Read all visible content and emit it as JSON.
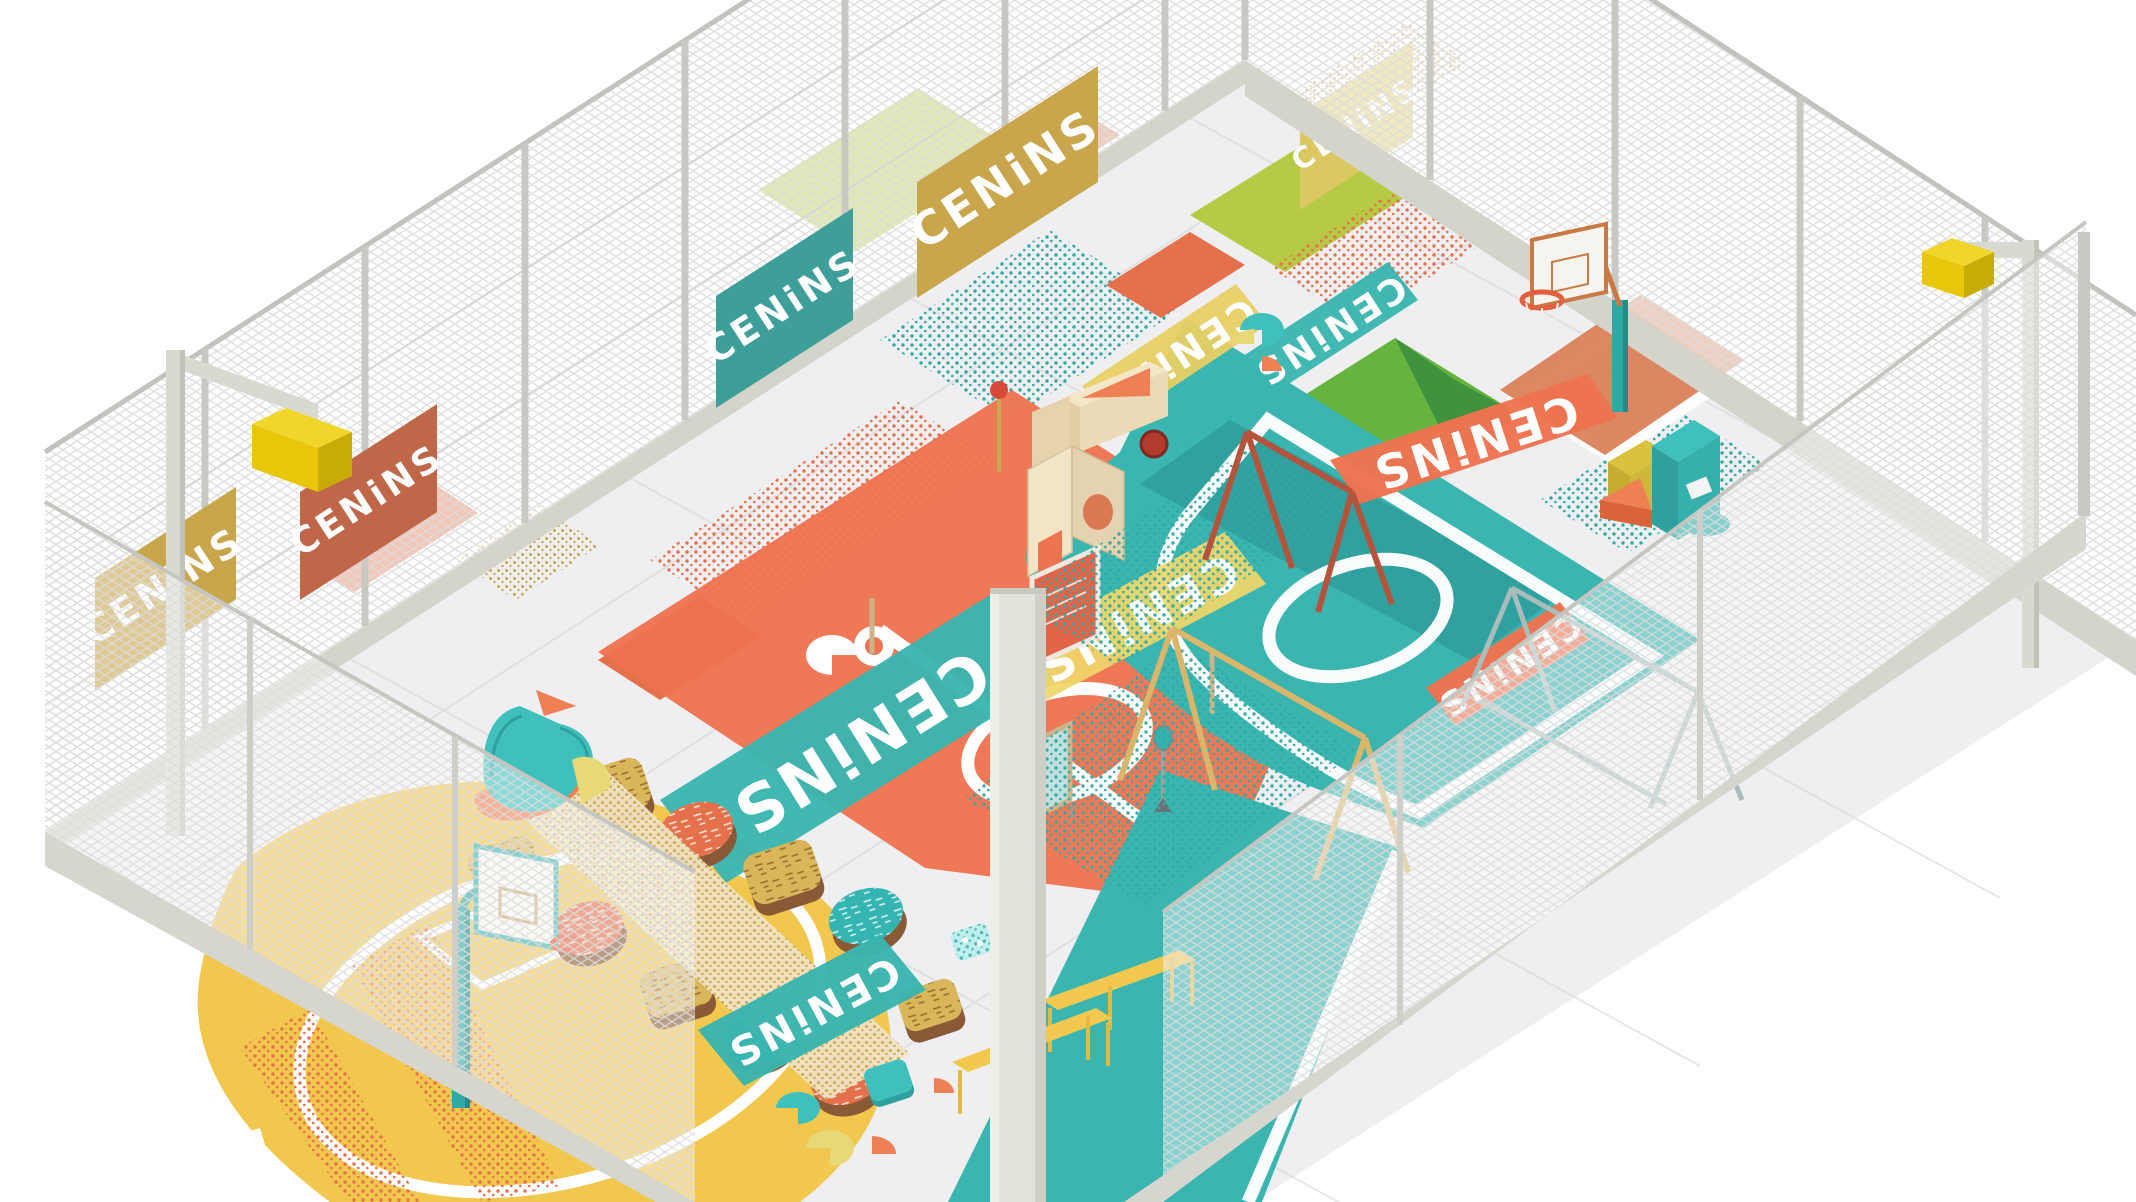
{
  "meta": {
    "type": "3d-isometric-render",
    "subject": "Fenced multi-sport playground court with CENiNS stencil branding",
    "canvas": {
      "width": 2136,
      "height": 1202
    },
    "background": "#ffffff"
  },
  "brand": {
    "stencil_text": "CENiNS",
    "style": "geometric cut-out stencil letters",
    "text_color": "#ffffff"
  },
  "palette": {
    "concrete": "#efeff1",
    "concrete_seam": "#d4d4d8",
    "curb": "#d4d4cb",
    "mesh": "#dcdcdc",
    "post": "#c6c6c0",
    "teal_court": "#3ab5b0",
    "teal_dark": "#2f9e9b",
    "teal_object": "#3fc0bd",
    "orange_court": "#ee7350",
    "orange_deep": "#e2603f",
    "yellow_court": "#f2c74e",
    "bench_yellow": "#f2c84f",
    "gold_banner": "#c9a64b",
    "pale_yellow_banner": "#dcc763",
    "lime_patch": "#b6ca45",
    "green_patch": "#67b33f",
    "green_dark": "#41923d",
    "rust_frame": "#bc5b41",
    "tan_frame": "#d9b66a",
    "steel_frame": "#a9bdbd",
    "plywood": "#ecdcbc",
    "wood_brown": "#8a5a36",
    "lamp_yellow": "#e8c70a",
    "white_line": "#ffffff"
  },
  "fence": {
    "mesh": "white chain-link on concrete curb",
    "banners": [
      {
        "id": "fence-banner-1",
        "color": "#c9a64b",
        "text": "CENiNS"
      },
      {
        "id": "fence-banner-2",
        "color": "#c0674a",
        "text": "CENiNS"
      },
      {
        "id": "fence-banner-3",
        "color": "#3e9e99",
        "text": "CENiNS"
      },
      {
        "id": "fence-banner-4",
        "color": "#c9a64b",
        "text": "CENiNS"
      },
      {
        "id": "fence-banner-5",
        "color": "#dcc763",
        "text": "CENiNS"
      }
    ]
  },
  "ground_banners": [
    {
      "id": "ground-banner-teal-center",
      "color": "#3ab5b0",
      "text": "CENiNS",
      "mirrored": true
    },
    {
      "id": "fabric-banner-yellow",
      "color": "#f0d66a",
      "text": "CENiNS",
      "mirrored": true
    },
    {
      "id": "court-banner-orange-upper",
      "color": "#ee7350",
      "text": "CENiNS",
      "mirrored": true
    },
    {
      "id": "court-banner-orange-lower",
      "color": "#ee7350",
      "text": "CENiNS",
      "mirrored": true
    },
    {
      "id": "ground-banner-yellow-north",
      "color": "#e8cf63",
      "text": "CENiNS",
      "mirrored": true
    },
    {
      "id": "ground-banner-teal-north",
      "color": "#3ab5b0",
      "text": "CENiNS",
      "mirrored": true
    },
    {
      "id": "court-banner-teal-yellowcourt",
      "color": "#3ab5b0",
      "text": "CENiNS",
      "mirrored": true
    }
  ],
  "courts": [
    {
      "name": "teal multi-sport court",
      "color": "#3ab5b0",
      "markings": [
        "white rounded boundary",
        "center circle",
        "key box at hoop",
        "large corner arc",
        "dark teal band"
      ]
    },
    {
      "name": "orange centre court",
      "color": "#ee7350",
      "markings": [
        "white center circle",
        "halfway line",
        "white quarter-disc glyphs"
      ]
    },
    {
      "name": "yellow half court",
      "color": "#f2c74e",
      "markings": [
        "white three-point ring",
        "key outline",
        "white quarter-disc glyph"
      ]
    }
  ],
  "patches": [
    "lime strips",
    "grass-green rectangles",
    "teal confetti strips",
    "orange confetti strips",
    "gold confetti strips",
    "orange rectangles"
  ],
  "equipment": [
    {
      "name": "basketball hoop north-east",
      "parts": "teal post, white backboard with wood frame, orange rim, white net, orange key patch"
    },
    {
      "name": "basketball hoop south-west",
      "parts": "teal post, white backboard, orange rim"
    },
    {
      "name": "rust A-frame with climbing net"
    },
    {
      "name": "tan A-frame with climbing net"
    },
    {
      "name": "steel A-frame goal"
    },
    {
      "name": "plywood play wall with porthole"
    },
    {
      "name": "wooden ball cart with red wheel"
    },
    {
      "name": "standing mirror"
    },
    {
      "name": "orange poster board"
    },
    {
      "name": "racket-shaped post"
    },
    {
      "name": "yellow benches",
      "count": 2
    },
    {
      "name": "teal crochet sofa on orange half-disc rug"
    },
    {
      "name": "wooden seating platforms with patterned tops",
      "count": 10
    },
    {
      "name": "pouf seats teal yellow orange"
    },
    {
      "name": "teal speckled play die"
    },
    {
      "name": "storage boxes teal yellow orange"
    },
    {
      "name": "wooden sign posts",
      "count": 4
    }
  ],
  "lighting": [
    {
      "name": "floodlight pole left",
      "lamp_color": "#e8c70a"
    },
    {
      "name": "floodlight pole right",
      "lamp_color": "#e8c70a"
    },
    {
      "name": "foreground concrete pole"
    }
  ]
}
